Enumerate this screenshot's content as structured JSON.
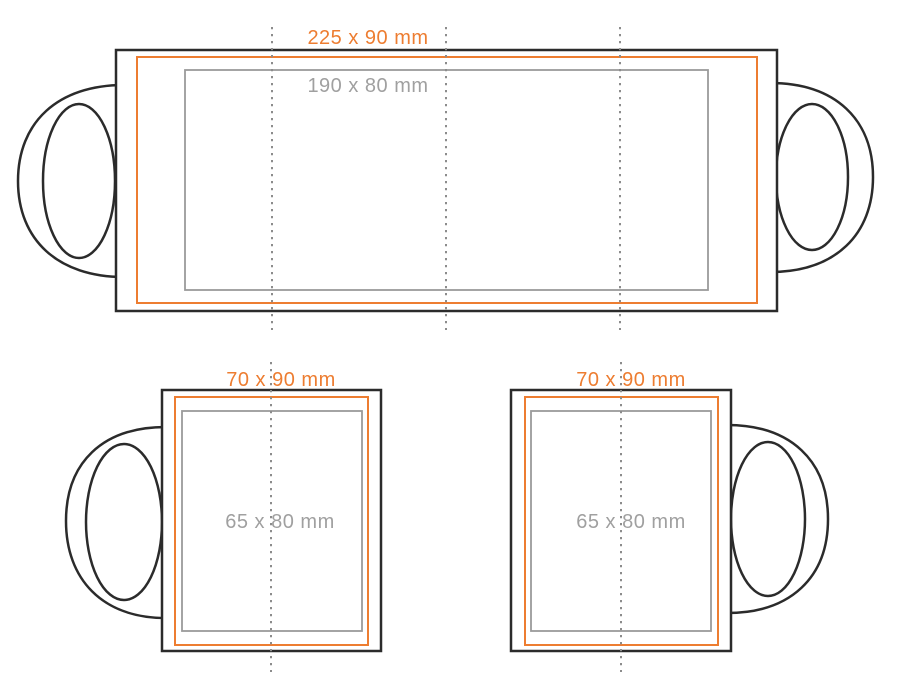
{
  "diagram": {
    "name": "mug-print-template",
    "background": "#ffffff"
  },
  "colors": {
    "outline": "#2b2b2b",
    "print_area": "#ed7d31",
    "safe_area": "#9a9a9a",
    "dotted": "#8c8c8c",
    "inner_label": "#a0a0a0"
  },
  "mugs": {
    "large": {
      "outer_size": "225 x 90 mm",
      "inner_size": "190 x 80 mm"
    },
    "small_left": {
      "outer_size": "70 x 90 mm",
      "inner_size": "65 x 80 mm"
    },
    "small_right": {
      "outer_size": "70 x 90 mm",
      "inner_size": "65 x 80 mm"
    }
  }
}
